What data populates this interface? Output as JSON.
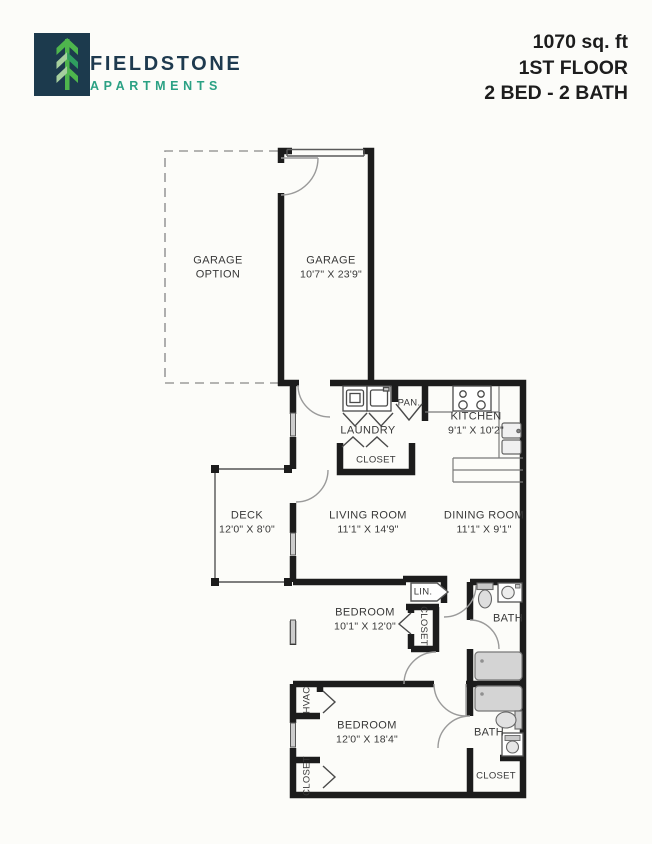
{
  "header": {
    "brand": {
      "name": "FIELDSTONE",
      "type": "APARTMENTS"
    },
    "unit_info": {
      "area": "1070 sq. ft",
      "floor": "1ST FLOOR",
      "beds_baths": "2 BED - 2 BATH"
    }
  },
  "rooms": {
    "garage_option": {
      "name": "GARAGE",
      "name2": "OPTION"
    },
    "garage": {
      "name": "GARAGE",
      "dims": "10'7\" X 23'9\""
    },
    "laundry": {
      "name": "LAUNDRY"
    },
    "pantry": {
      "name": "PAN."
    },
    "laundry_closet": {
      "name": "CLOSET"
    },
    "kitchen": {
      "name": "KITCHEN",
      "dims": "9'1\" X 10'2\""
    },
    "deck": {
      "name": "DECK",
      "dims": "12'0\" X 8'0\""
    },
    "living": {
      "name": "LIVING ROOM",
      "dims": "11'1\" X 14'9\""
    },
    "dining": {
      "name": "DINING ROOM",
      "dims": "11'1\" X 9'1\""
    },
    "linen": {
      "name": "LIN."
    },
    "bedroom1": {
      "name": "BEDROOM",
      "dims": "10'1\" X 12'0\""
    },
    "bedroom1_closet": {
      "name": "CLOSET"
    },
    "bath1": {
      "name": "BATH"
    },
    "hvac": {
      "name": "HVAC"
    },
    "bedroom2": {
      "name": "BEDROOM",
      "dims": "12'0\" X 18'4\""
    },
    "bedroom2_closet": {
      "name": "CLOSET"
    },
    "bath2": {
      "name": "BATH"
    },
    "bath2_closet": {
      "name": "CLOSET"
    }
  },
  "colors": {
    "brand_navy": "#1c3a4d",
    "brand_teal": "#2ba184",
    "logo_green": "#4eb54d",
    "logo_green_light": "#a6cf9e",
    "logo_green_dark": "#2f9e5f",
    "wall": "#1c1c1c",
    "fixture_gray": "#d4d4d4",
    "background": "#fcfcf9"
  }
}
